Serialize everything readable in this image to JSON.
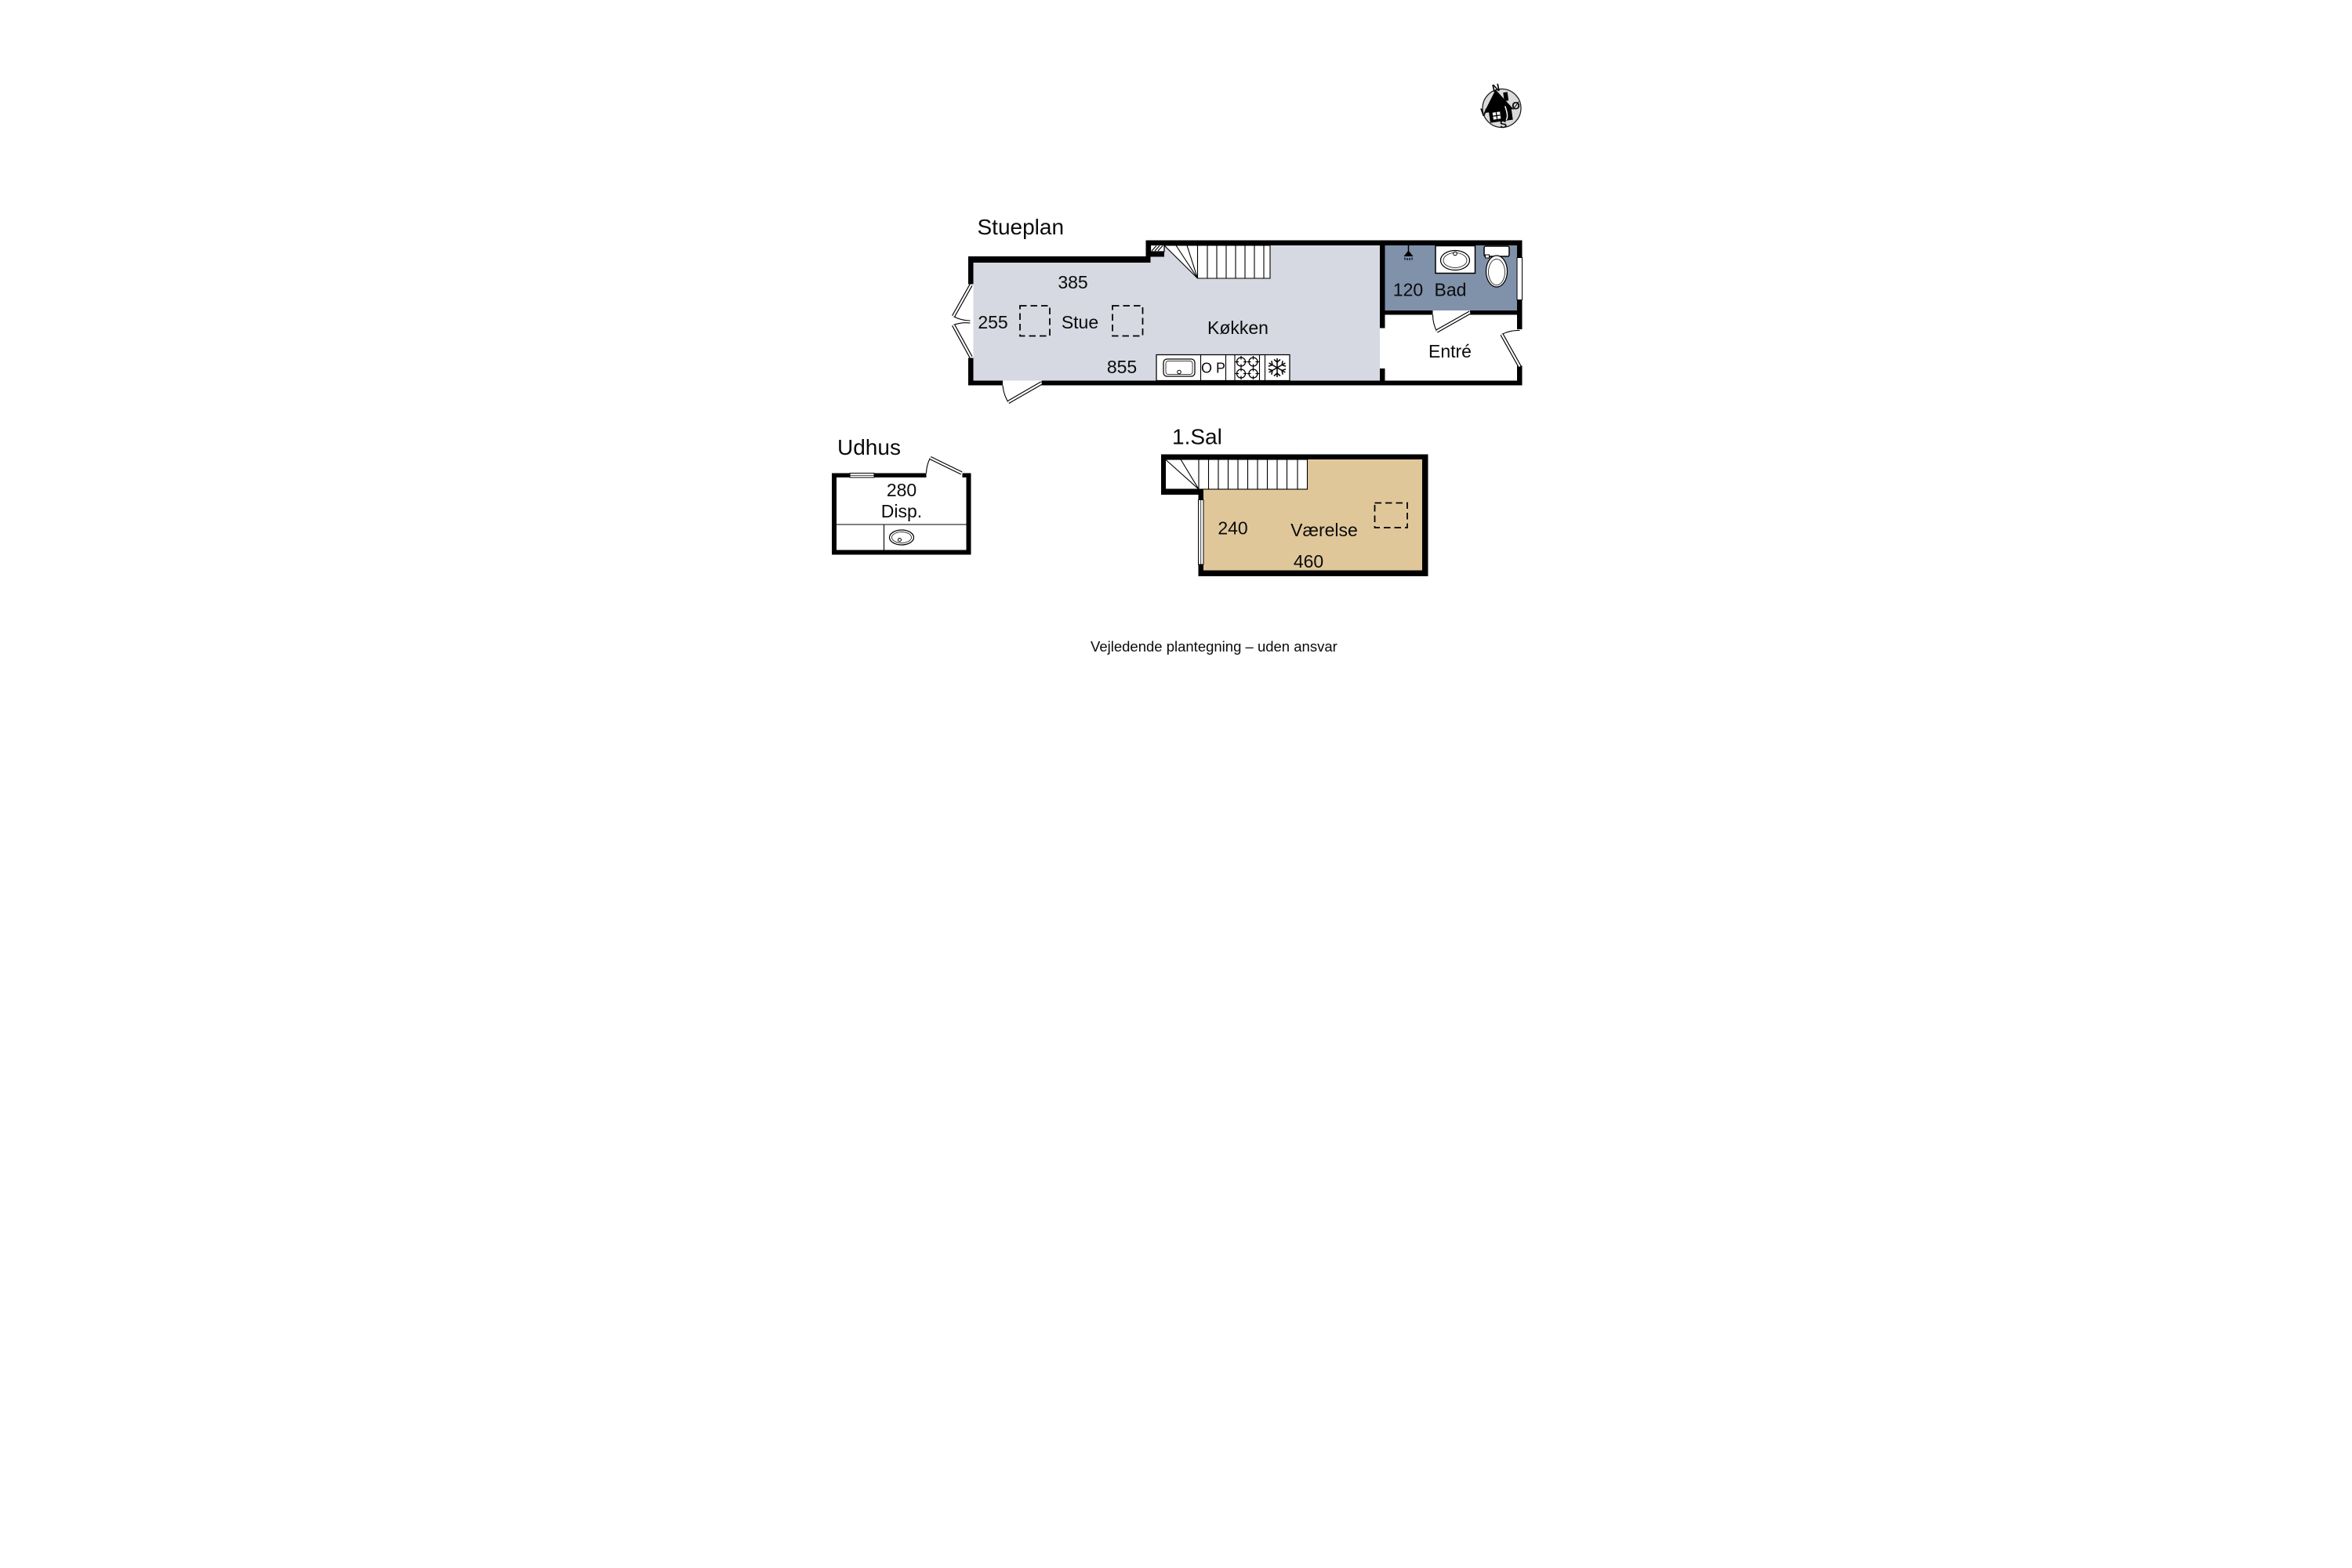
{
  "compass": {
    "n": "N",
    "e": "Ø",
    "s": "S",
    "v": "V"
  },
  "ground_floor": {
    "title": "Stueplan",
    "living_room": {
      "name": "Stue",
      "dim_top": "385",
      "dim_left": "255",
      "dim_bottom": "855"
    },
    "kitchen": {
      "name": "Køkken",
      "dishwasher_label": "O P"
    },
    "bathroom": {
      "name": "Bad",
      "dim": "120"
    },
    "hallway": {
      "name": "Entré"
    }
  },
  "outbuilding": {
    "title": "Udhus",
    "storage": {
      "name": "Disp.",
      "dim": "280"
    }
  },
  "first_floor": {
    "title": "1.Sal",
    "room": {
      "name": "Værelse",
      "dim_left": "240",
      "dim_bottom": "460"
    }
  },
  "footer": {
    "disclaimer": "Vejledende plantegning – uden ansvar"
  },
  "colors": {
    "wall": "#000000",
    "living_floor": "#d6d9e2",
    "bath_floor": "#8091aa",
    "first_floor_room": "#e0c79a",
    "compass_bg": "#dbdbdd"
  },
  "icons": {
    "compass": "compass-rose-house",
    "bathroom_fixtures": [
      "shower-icon",
      "sink-icon",
      "toilet-icon"
    ],
    "kitchen_fixtures": [
      "sink-icon",
      "dishwasher-icon",
      "stove-icon",
      "freezer-icon"
    ],
    "outbuilding_fixtures": [
      "sink-icon"
    ],
    "stairs": "stairs-icon",
    "roof_window": "dashed-roof-window-icon"
  }
}
